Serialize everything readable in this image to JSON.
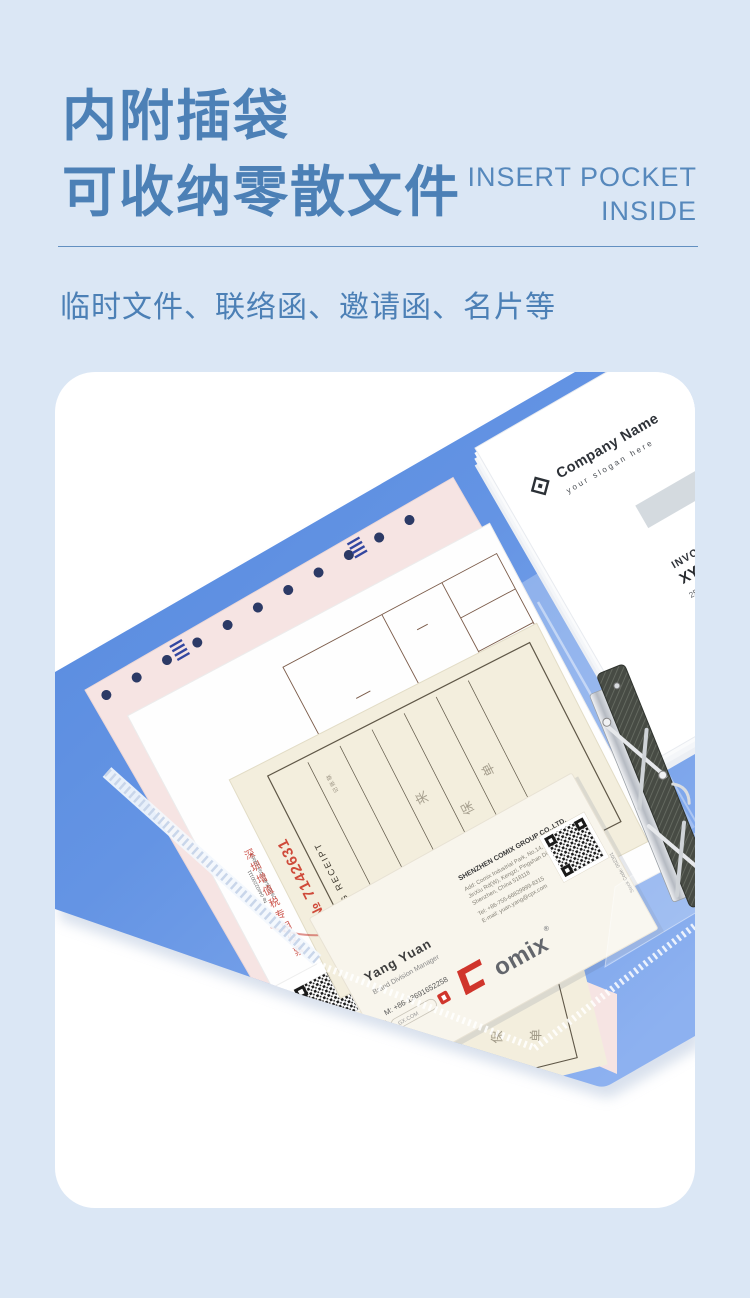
{
  "page": {
    "background": "#dbe7f5",
    "accent_blue": "#4c80b6",
    "folder_blue": "#6093e3",
    "item_bar_blue": "#1566c4",
    "stamp_red": "#c4392f"
  },
  "header": {
    "title_line1": "内附插袋",
    "title_line2": "可收纳零散文件",
    "subtitle_en_line1": "INSERT POCKET",
    "subtitle_en_line2": "INSIDE",
    "description": "临时文件、联络函、邀请函、名片等"
  },
  "photo": {
    "letterhead": {
      "company": "Company Name",
      "slogan": "your slogan here",
      "invoice_to": "INVOICE TO",
      "client": "XYZ CO. LTD.",
      "address_line1": "256 North Tower, L...",
      "address_line2": "contact@your em...",
      "address_line3": "+008 1268 987...",
      "item_label": "ITEM"
    },
    "business_card": {
      "name": "Yang Yuan",
      "title": "Brand Division Manager",
      "mobile": "M: +86-13691652258",
      "site_badge": "GX.COM",
      "company": "SHENZHEN COMIX GROUP CO.,LTD.",
      "address_line1": "Add: Comix Industrial Park, No.14,",
      "address_line2": "JinXiu Rd(W), Kengzi, Pingshan District,",
      "address_line3": "Shenzhen, China 518118",
      "tel": "Tel: +86-755-66829999-8315",
      "email": "E-mail: yuan.yang@cpx.com",
      "stock": "Stock Code: 002301",
      "logo_text": "omix",
      "registered": "®"
    },
    "receipt": {
      "serial": "№ 7142631",
      "label": "VG RECEIPT",
      "stamp_vertical": "深圳增值税专用发票",
      "daikai": "代开"
    },
    "texture": {
      "form_serial": "№ 04402200111",
      "form_code": "76062646 2034 10062",
      "form_date": "2023 08 17 07 23",
      "form_digits1": "3453876+354+4233",
      "form_digits2": "84285376-234-2233",
      "form_digits3": "+91<27>+2+2423",
      "form_digits4": "3<8>818-962-697",
      "form_col_right": "价税合计(大写)",
      "receipt_head": "记 账 联",
      "receipt_char1": "湘",
      "receipt_char2": "来",
      "receipt_char3": "保",
      "receipt_char4": "单",
      "box_footer": "收 据 专 用"
    }
  }
}
